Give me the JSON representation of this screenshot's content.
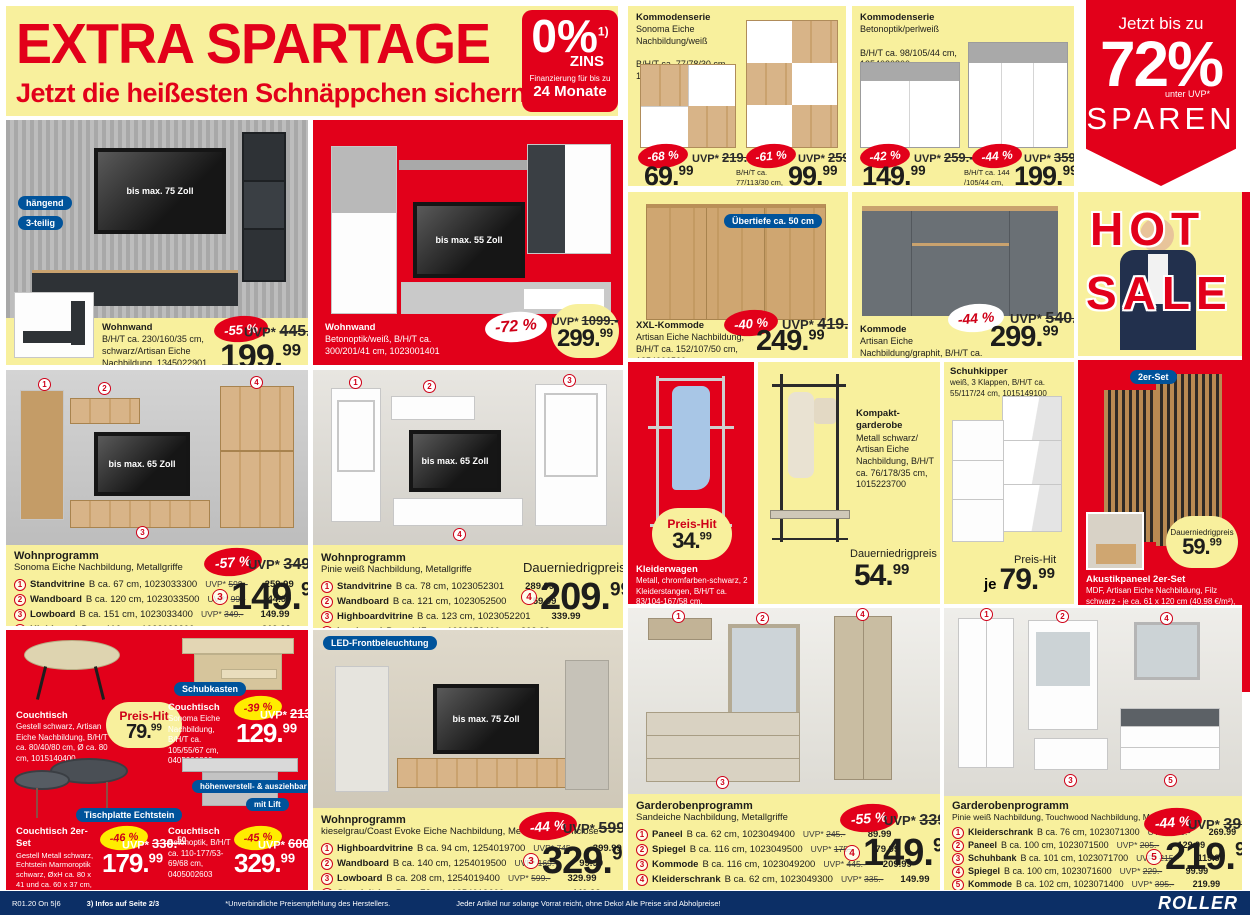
{
  "labels": {
    "uvp": "UVP*",
    "dnp": "Dauerniedrigpreis",
    "ph": "Preis-Hit",
    "je": "je"
  },
  "header": {
    "title": "EXTRA SPARTAGE",
    "subtitle": "Jetzt die heißesten Schnäppchen sichern!"
  },
  "zins": {
    "pct": "0%",
    "sup": "1)",
    "unit": "ZINS",
    "fin1": "Finanzierung für bis zu",
    "fin2": "24 Monate"
  },
  "ribbon": {
    "l1": "Jetzt bis zu",
    "pct": "72%",
    "note": "unter UVP*",
    "l2": "SPAREN"
  },
  "k1": {
    "name": "Kommodenserie",
    "desc": "Sonoma Eiche Nachbildung/weiß",
    "dims1": "B/H/T ca. 77/78/30 cm,",
    "sku1": "1023015803",
    "b1": "-68 %",
    "uvp1": "219.-",
    "p1i": "69.",
    "p1s": "99",
    "dims2": "B/H/T ca. 77/113/30 cm,",
    "sku2": "1023015903",
    "b2": "-61 %",
    "uvp2": "259.-",
    "p2i": "99.",
    "p2s": "99"
  },
  "k2": {
    "name": "Kommodenserie",
    "desc": "Betonoptik/perlweiß",
    "dims1": "B/H/T ca. 98/105/44 cm,",
    "sku1": "1254020800",
    "b1": "-42 %",
    "uvp1": "259.-",
    "p1i": "149.",
    "p1s": "99",
    "dims2": "B/H/T ca. 144 /105/44 cm,",
    "sku2": "1254020900",
    "b2": "-44 %",
    "uvp2": "359.-",
    "p2i": "199.",
    "p2s": "99"
  },
  "wwl": {
    "pill1": "hängend",
    "pill2": "3-teilig",
    "tv": "bis max. 75 Zoll",
    "name": "Wohnwand",
    "desc": "B/H/T ca. 230/160/35 cm, schwarz/Artisan Eiche Nachbildung, 1345022901, Karlstad Eiche Nachbildung/grau, 1345022900",
    "badge": "-55 %",
    "uvp": "445.",
    "uvps": "50",
    "pi": "199.",
    "ps": "99"
  },
  "wwm": {
    "tv": "bis max. 55 Zoll",
    "name": "Wohnwand",
    "desc": "Betonoptik/weiß, B/H/T ca. 300/201/41 cm, 1023001401",
    "badge": "-72 %",
    "uvp": "1099.-",
    "pi": "299.",
    "ps": "99"
  },
  "xxl": {
    "pill": "Übertiefe ca. 50 cm",
    "name": "XXL-Kommode",
    "desc": "Artisan Eiche Nachbildung, B/H/T ca. 152/107/50 cm, 1254006500",
    "badge": "-40 %",
    "uvp": "419.-",
    "pi": "249.",
    "ps": "99"
  },
  "kg": {
    "name": "Kommode",
    "desc": "Artisan Eiche Nachbildung/graphit, B/H/T ca. 180/90/40 cm, 1345025600",
    "badge": "-44 %",
    "uvp": "540.-",
    "pi": "299.",
    "ps": "99"
  },
  "hot": {
    "l1": "HOT",
    "l2": "SALE"
  },
  "wpl": {
    "name": "Wohnprogramm",
    "desc": "Sonoma Eiche Nachbildung, Metallgriffe",
    "tv": "bis max. 65 Zoll",
    "rows": [
      {
        "n": "1",
        "name": "Standvitrine",
        "info": "B ca. 67 cm, 1023033300",
        "uvp": "599.-",
        "price": "259.99"
      },
      {
        "n": "2",
        "name": "Wandboard",
        "info": "B ca. 120 cm, 1023033500",
        "uvp": "99.-",
        "price": "44.99"
      },
      {
        "n": "3",
        "name": "Lowboard",
        "info": "B ca. 151 cm, 1023033400",
        "uvp": "349.-",
        "price": "149.99"
      },
      {
        "n": "4",
        "name": "Highboard",
        "info": "B ca. 116 cm, 1023033200",
        "uvp": "539.-",
        "price": "319.99"
      }
    ],
    "badge": "-57 %",
    "uvp": "349.-",
    "circ": "3",
    "pi": "149.",
    "ps": "99"
  },
  "wpm": {
    "name": "Wohnprogramm",
    "desc": "Pinie weiß Nachbildung, Metallgriffe",
    "tv": "bis max. 65 Zoll",
    "rows": [
      {
        "n": "1",
        "name": "Standvitrine",
        "info": "B ca. 78 cm, 1023052301",
        "price": "289.99"
      },
      {
        "n": "2",
        "name": "Wandboard",
        "info": "B ca. 121 cm, 1023052500",
        "price": "59.99"
      },
      {
        "n": "3",
        "name": "Highboardvitrine",
        "info": "B ca. 123 cm, 1023052201",
        "price": "339.99"
      },
      {
        "n": "4",
        "name": "Lowboard",
        "info": "B ca. 147 cm, 1023052400",
        "price": "209.99"
      }
    ],
    "label": "Dauerniedrigpreis",
    "circ": "4",
    "pi": "209.",
    "ps": "99"
  },
  "klw": {
    "ph": "Preis-Hit",
    "pi": "34.",
    "ps": "99",
    "name": "Kleiderwagen",
    "desc": "Metall, chromfarben-schwarz, 2 Kleiderstangen, B/H/T ca. 83/104-167/58 cm, 1015173700"
  },
  "kgd": {
    "name": "Kompakt-garderobe",
    "desc": "Metall schwarz/ Artisan Eiche Nachbildung, B/H/T ca. 76/178/35 cm, 1015223700",
    "label": "Dauerniedrigpreis",
    "pi": "54.",
    "ps": "99"
  },
  "shk": {
    "name": "Schuhkipper",
    "desc": "weiß, 3 Klappen, B/H/T ca. 55/117/24 cm, 1015149100",
    "ph": "Preis-Hit",
    "je": "je",
    "pi": "79.",
    "ps": "99"
  },
  "akp": {
    "pill": "2er-Set",
    "label": "Dauerniedrigpreis",
    "pi": "59.",
    "ps": "99",
    "name": "Akustikpaneel 2er-Set",
    "desc": "MDF, Artisan Eiche Nachbildung, Filz schwarz - je ca. 61 x 120 cm (40.98 €/m²), 1015111600"
  },
  "cou": {
    "p1": {
      "name": "Couchtisch",
      "desc": "Gestell schwarz, Artisan Eiche Nachbildung, B/H/T ca. 80/40/80 cm, Ø ca. 80 cm, 1015140400",
      "ph": "Preis-Hit",
      "pi": "79.",
      "ps": "99"
    },
    "p2": {
      "pill": "Schubkasten",
      "name": "Couchtisch",
      "desc": "Sonoma Eiche Nachbildung, B/H/T ca. 105/55/67 cm, 0405000800",
      "badge": "-39 %",
      "uvp": "213.",
      "uvps": "50",
      "pi": "129.",
      "ps": "99"
    },
    "p3": {
      "pill": "Tischplatte Echtstein",
      "name": "Couchtisch 2er-Set",
      "desc": "Gestell Metall schwarz, Echtstein Marmoroptik schwarz, ØxH ca. 80 x 41 und ca. 60 x 37 cm, 0405031200",
      "badge": "-46 %",
      "uvp": "330.",
      "uvps": "50",
      "pi": "179.",
      "ps": "99"
    },
    "p4": {
      "pill1": "höhenverstell- & ausziehbar",
      "pill2": "mit Lift",
      "name": "Couchtisch",
      "desc": "Betonoptik, B/H/T ca. 110-177/53-69/68 cm, 0405002603",
      "badge": "-45 %",
      "uvp": "600.",
      "uvps": "50",
      "pi": "329.",
      "ps": "99"
    }
  },
  "wpb": {
    "pill": "LED-Frontbeleuchtung",
    "tv": "bis max. 75 Zoll",
    "name": "Wohnprogramm",
    "desc": "kieselgrau/Coast Evoke Eiche Nachbildung, Metallgriffe, Softclose",
    "rows": [
      {
        "n": "1",
        "name": "Highboardvitrine",
        "info": "B ca. 94 cm, 1254019700",
        "uvp": "745.-",
        "price": "399.99"
      },
      {
        "n": "2",
        "name": "Wandboard",
        "info": "B ca. 140 cm, 1254019500",
        "uvp": "169.-",
        "price": "99.99"
      },
      {
        "n": "3",
        "name": "Lowboard",
        "info": "B ca. 208 cm, 1254019400",
        "uvp": "599.-",
        "price": "329.99"
      },
      {
        "n": "4",
        "name": "Standvitrine",
        "info": "B ca. 72 cm, 1254019600",
        "uvp": "795.-",
        "price": "449.99"
      }
    ],
    "badge": "-44 %",
    "uvp": "599.-",
    "circ": "3",
    "pi": "329.",
    "ps": "99"
  },
  "gds": {
    "name": "Garderobenprogramm",
    "desc": "Sandeiche Nachbildung, Metallgriffe",
    "rows": [
      {
        "n": "1",
        "name": "Paneel",
        "info": "B ca. 62 cm, 1023049400",
        "uvp": "245.-",
        "price": "89.99"
      },
      {
        "n": "2",
        "name": "Spiegel",
        "info": "B ca. 116 cm, 1023049500",
        "uvp": "175.-",
        "price": "79.99"
      },
      {
        "n": "3",
        "name": "Kommode",
        "info": "B ca. 116 cm, 1023049200",
        "uvp": "445.-",
        "price": "209.99"
      },
      {
        "n": "4",
        "name": "Kleiderschrank",
        "info": "B ca. 62 cm, 1023049300",
        "uvp": "335.-",
        "price": "149.99"
      }
    ],
    "badge": "-55 %",
    "uvp": "339.-",
    "circ": "4",
    "pi": "149.",
    "ps": "99"
  },
  "gdp": {
    "name": "Garderobenprogramm",
    "desc": "Pinie weiß Nachbildung, Touchwood Nachbildung, Metallgriffe",
    "rows": [
      {
        "n": "1",
        "name": "Kleiderschrank",
        "info": "B ca. 76 cm, 1023071300",
        "uvp": "505.-",
        "price": "269.99"
      },
      {
        "n": "2",
        "name": "Paneel",
        "info": "B ca. 100 cm, 1023071500",
        "uvp": "205.-",
        "price": "129.99"
      },
      {
        "n": "3",
        "name": "Schuhbank",
        "info": "B ca. 101 cm, 1023071700",
        "uvp": "215.-",
        "price": "119.99"
      },
      {
        "n": "4",
        "name": "Spiegel",
        "info": "B ca. 100 cm, 1023071600",
        "uvp": "229.-",
        "price": "99.99"
      },
      {
        "n": "5",
        "name": "Kommode",
        "info": "B ca. 102 cm, 1023071400",
        "uvp": "395.-",
        "price": "219.99"
      }
    ],
    "badge": "-44 %",
    "uvp": "399.-",
    "circ": "5",
    "pi": "219.",
    "ps": "99"
  },
  "footer": {
    "code": "R01.20 On 5|6",
    "info": "3) Infos auf Seite 2/3",
    "center": "*Unverbindliche Preisempfehlung des Herstellers.",
    "right": "Jeder Artikel nur solange Vorrat reicht, ohne Deko! Alle Preise sind Abholpreise!",
    "logo": "ROLLER"
  }
}
